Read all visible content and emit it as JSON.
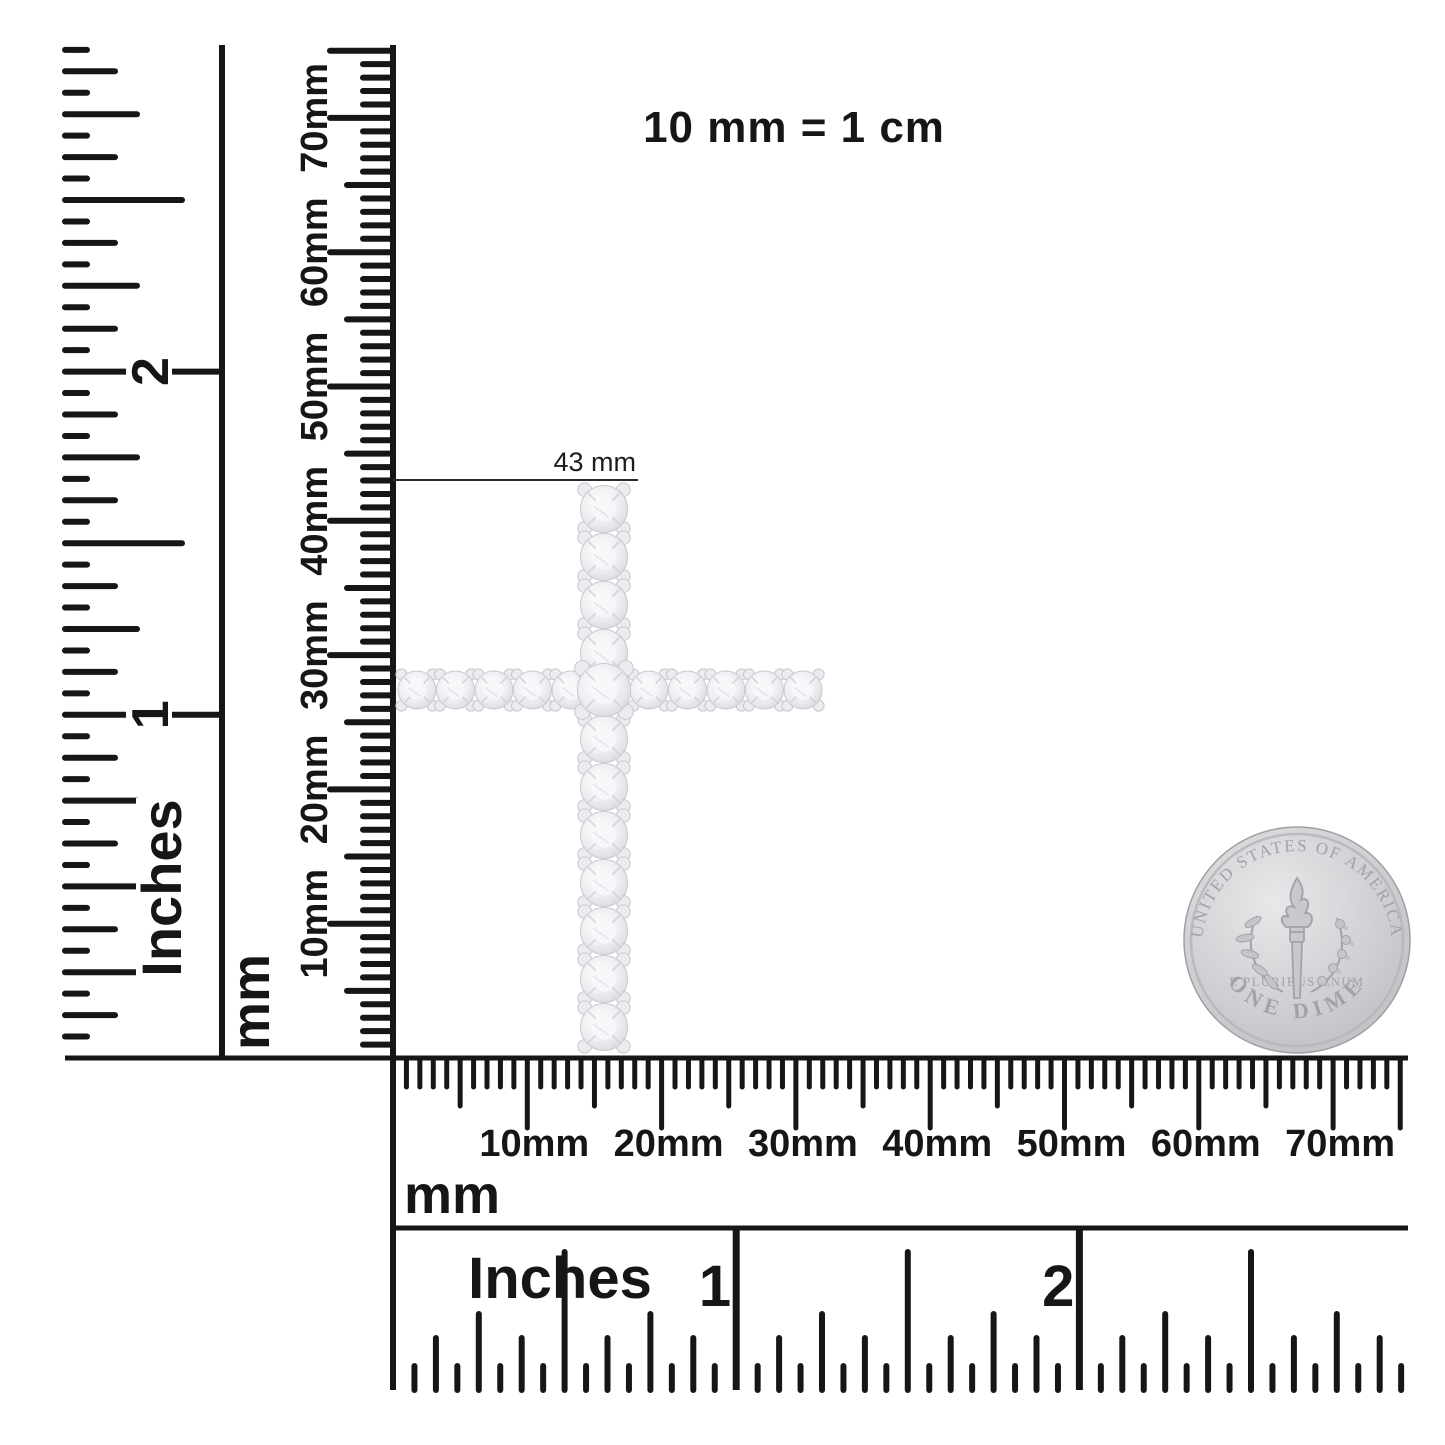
{
  "background_color": "#ffffff",
  "ink_color": "#161616",
  "scale_note": "10 mm = 1 cm",
  "measurement_label": "43 mm",
  "rulers": {
    "left_inches": {
      "unit": "Inches",
      "numerals": [
        "1",
        "2"
      ]
    },
    "left_mm": {
      "unit": "mm",
      "labels": [
        "10mm",
        "20mm",
        "30mm",
        "40mm",
        "50mm",
        "60mm",
        "70mm"
      ]
    },
    "bottom_mm": {
      "unit": "mm",
      "labels": [
        "10mm",
        "20mm",
        "30mm",
        "40mm",
        "50mm",
        "60mm",
        "70mm"
      ]
    },
    "bottom_inches": {
      "unit": "Inches",
      "numerals": [
        "1",
        "2"
      ]
    }
  },
  "coin": {
    "top_text": "UNITED STATES OF AMERICA",
    "middle_text": "E PLURIBUS UNUM",
    "bottom_text": "ONE DIME",
    "base_color": "#cdcdd1",
    "detail_color": "#a2a2a8"
  },
  "pendant": {
    "description": "diamond cross pendant",
    "height_label": "43 mm",
    "vertical_stone_count": 12,
    "horizontal_stone_count": 11,
    "stone_color": "#eeeef2"
  }
}
